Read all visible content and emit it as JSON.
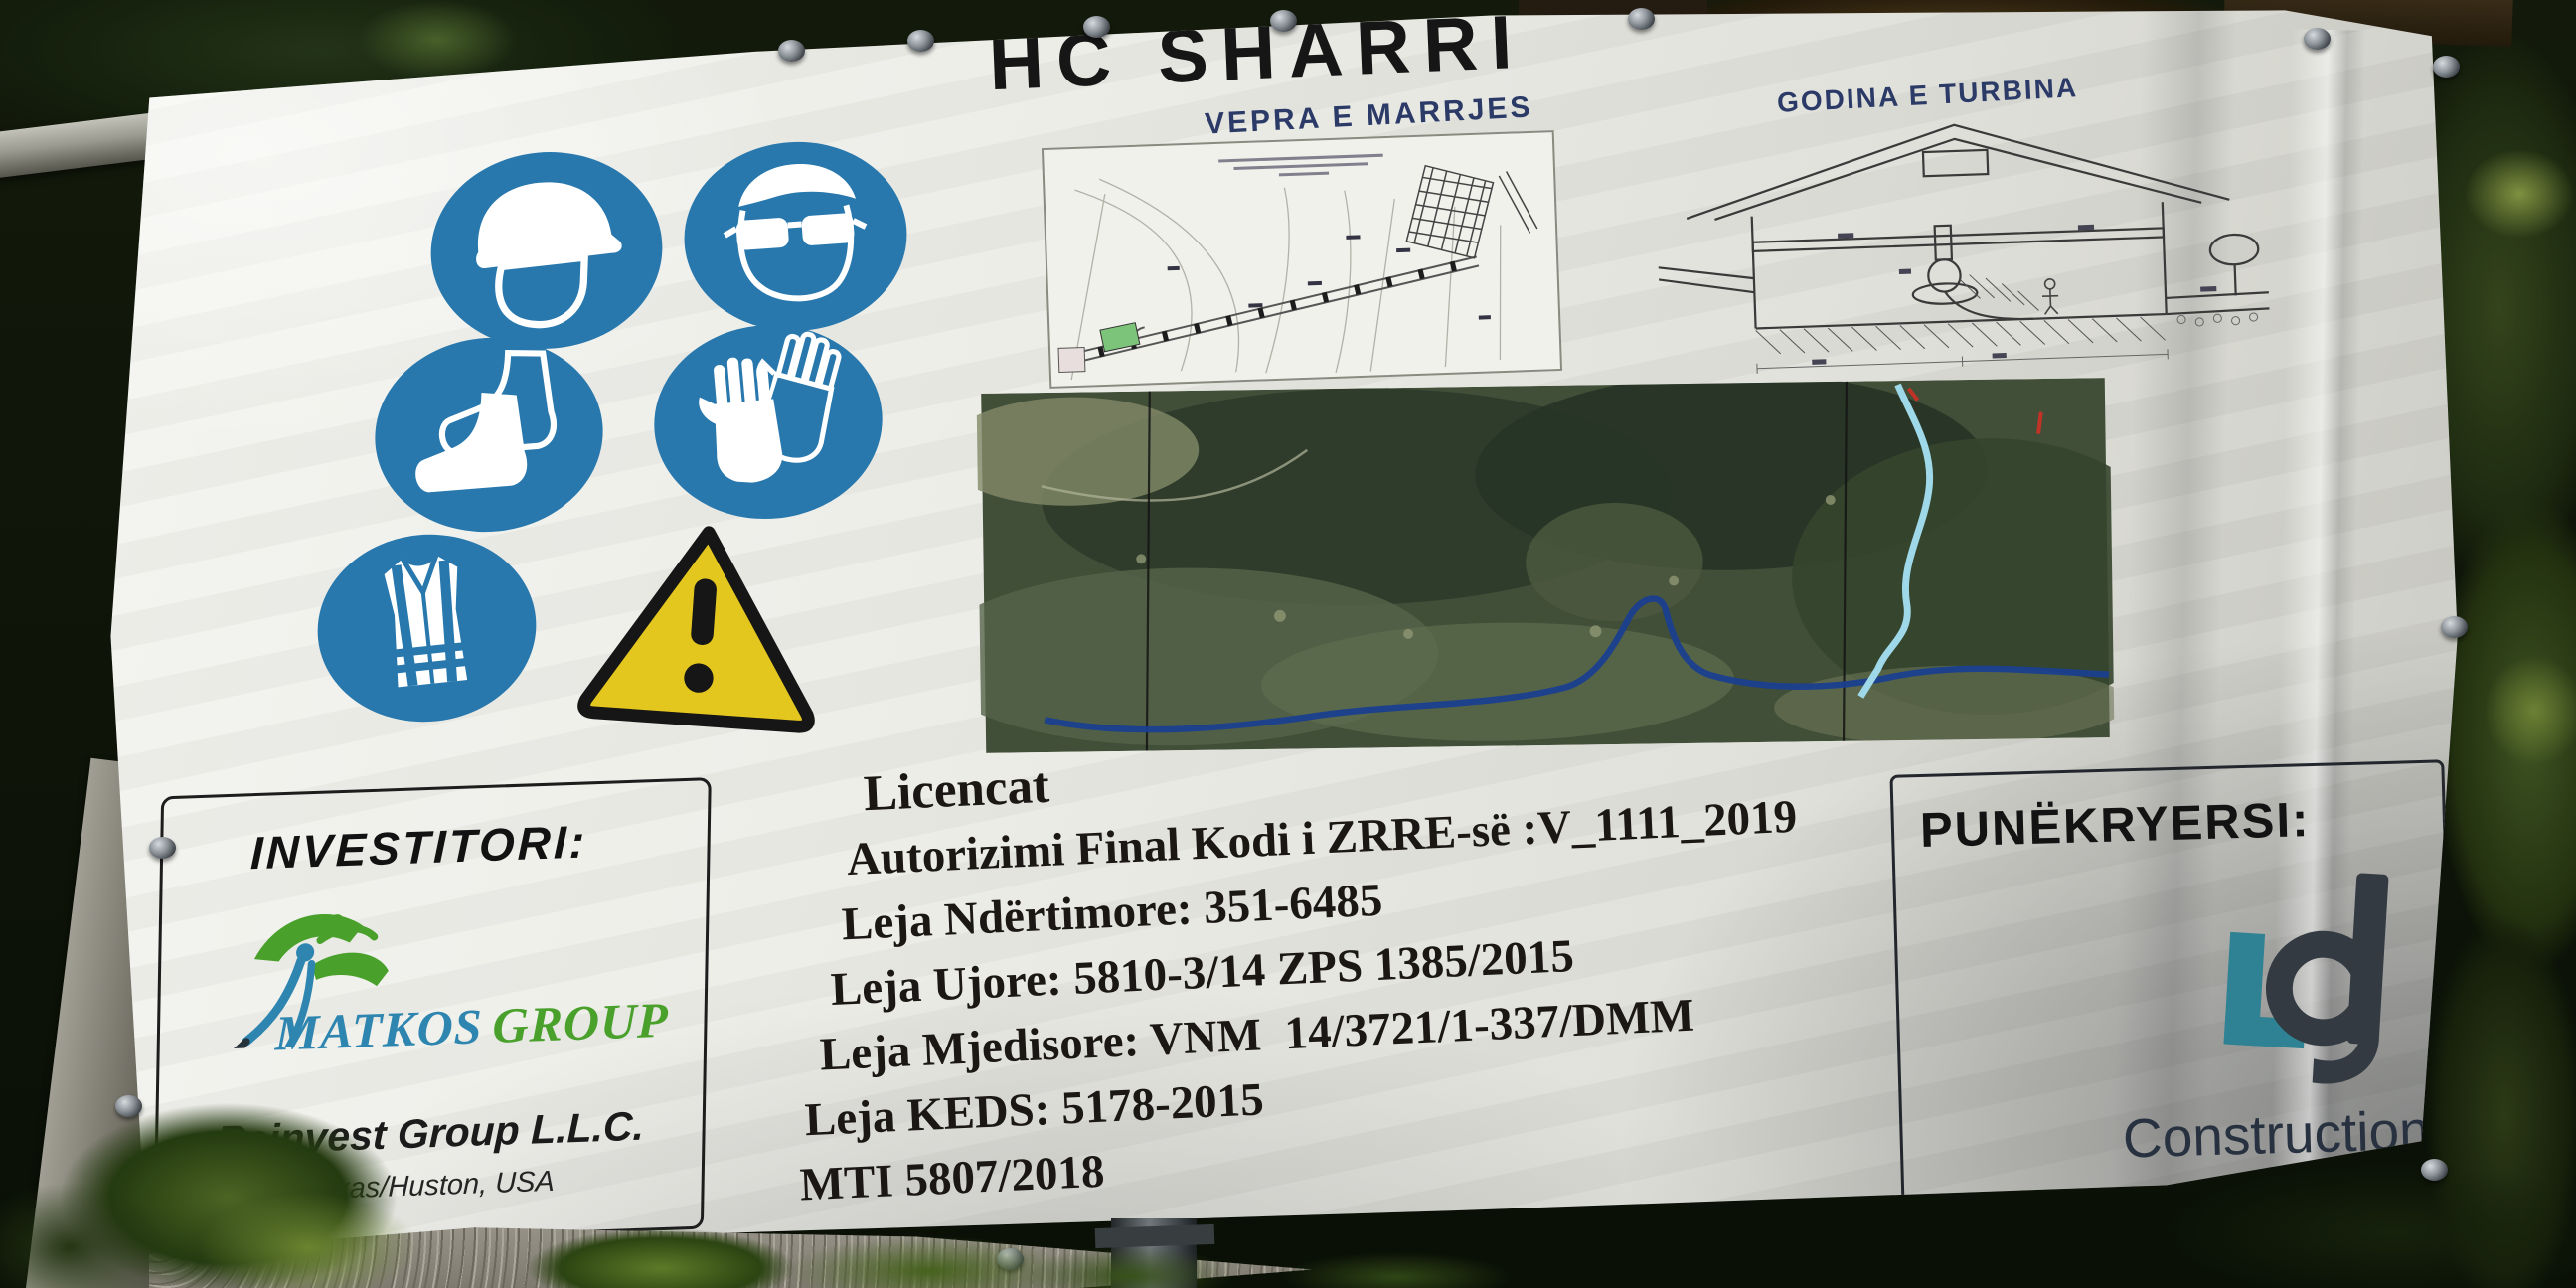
{
  "scene": {
    "description": "Construction information billboard for hydropower plant HC Sharri, mounted on a metal frame among dark trees"
  },
  "sign": {
    "title": "HC SHARRI",
    "drawings": {
      "left_label": "VEPRA E MARRJES",
      "right_label": "GODINA E TURBINA"
    },
    "safety_icons": [
      "hard-hat",
      "eye-protection",
      "safety-boots",
      "protective-gloves",
      "high-visibility-vest",
      "general-warning"
    ],
    "investor": {
      "heading": "INVESTITORI:",
      "logo_word_1": "MATKOS",
      "logo_word_2": "GROUP",
      "company": "Reinvest Group L.L.C.",
      "location": "Texas/Huston, USA"
    },
    "licenses": {
      "heading": "Licencat",
      "items": [
        "Autorizimi Final Kodi i ZRRE-së :V_1111_2019",
        "Leja Ndërtimore: 351-6485",
        "Leja Ujore: 5810-3/14 ZPS 1385/2015",
        "Leja Mjedisore: VNM  14/3721/1-337/DMM",
        "Leja KEDS: 5178-2015",
        "MTI 5807/2018"
      ]
    },
    "contractor": {
      "heading": "PUNËKRYERSI:",
      "company_word_1": "Construction",
      "company_word_2": "Group"
    },
    "colors": {
      "safety_blue": "#2878ad",
      "warning_yellow": "#e4c71e",
      "drawing_label_blue": "#2b3a66",
      "matkos_blue": "#2e86b0",
      "matkos_green": "#49a12c",
      "lg_teal": "#2e8294",
      "lg_charcoal": "#333a41",
      "banner_white": "#e9e9e4",
      "river_dark_blue": "#1b3f8f",
      "penstock_cyan": "#9fd8e8"
    }
  }
}
